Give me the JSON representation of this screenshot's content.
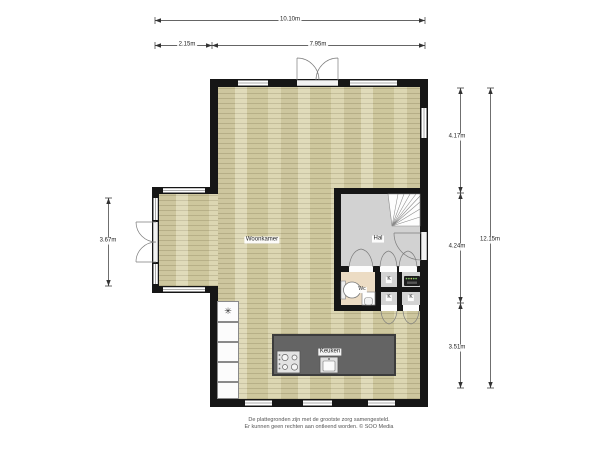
{
  "dimensions": {
    "total_width": "10.10m",
    "bay_width": "2.15m",
    "main_width": "7.95m",
    "right_top": "4.17m",
    "right_middle": "4.24m",
    "right_bottom": "3.51m",
    "total_height": "12.15m",
    "bay_height": "3.67m"
  },
  "rooms": {
    "living_room": "Woonkamer",
    "hallway": "Hal",
    "toilet": "Wc",
    "kitchen": "Keuken",
    "closet": "K"
  },
  "symbols": {
    "freezer": "✳"
  },
  "footer": {
    "line1": "De plattegronden zijn met de grootste zorg samengesteld.",
    "line2": "Er kunnen geen rechten aan ontleend worden. © SOO Media"
  },
  "colors": {
    "wall": "#161616",
    "wood_floor": "#d8d2a9",
    "hall_floor": "#d2d2d2",
    "toilet_floor": "#ecdcc4",
    "kitchen_island": "#646464"
  }
}
